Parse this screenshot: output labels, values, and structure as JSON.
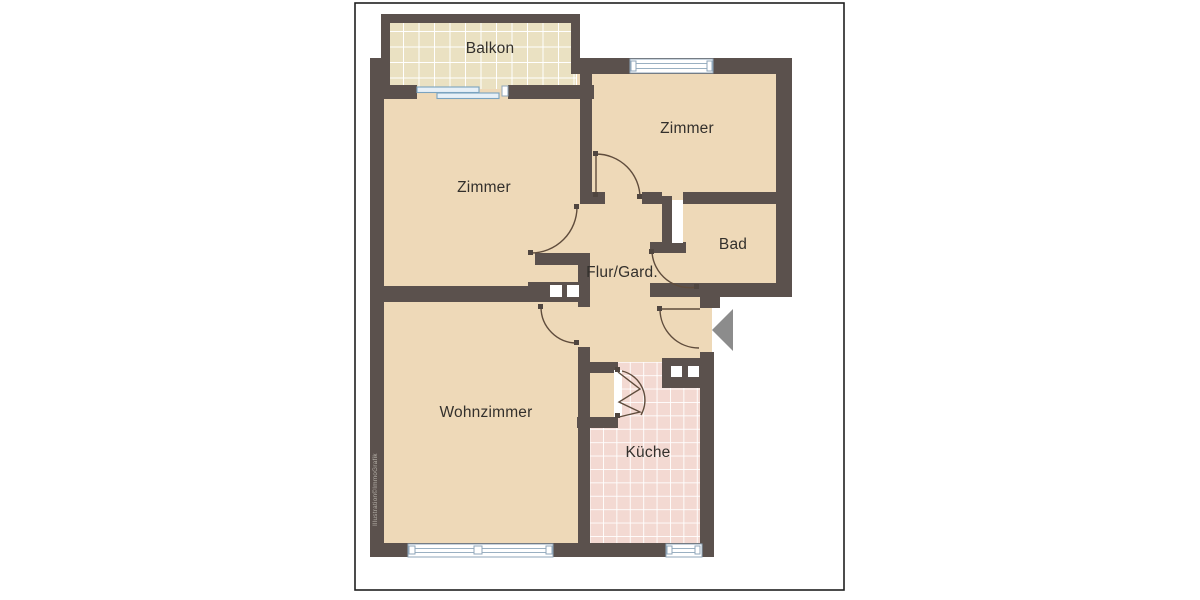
{
  "document": {
    "type": "floor-plan",
    "background": "#ffffff",
    "border_color": "#1f1f1f"
  },
  "colors": {
    "wall": "#5b514d",
    "floor": "#eed9b8",
    "balcony_tile": "#eae1c2",
    "kitchen_tile": "#f3d9d2",
    "tile_grid": "#ffffff",
    "window_frame": "#8fa6ba",
    "door_arc": "#5f4c3c",
    "entry_arrow": "#8c8c8c",
    "label_text": "#33302c"
  },
  "rooms": [
    {
      "id": "balkon",
      "label": "Balkon"
    },
    {
      "id": "zimmer-left",
      "label": "Zimmer"
    },
    {
      "id": "zimmer-right",
      "label": "Zimmer"
    },
    {
      "id": "bad",
      "label": "Bad"
    },
    {
      "id": "flur-garderobe",
      "label": "Flur/Gard."
    },
    {
      "id": "wohnzimmer",
      "label": "Wohnzimmer"
    },
    {
      "id": "kueche",
      "label": "Küche"
    }
  ],
  "watermark": {
    "text": "Illustration©ImmoGrafik"
  },
  "features": {
    "entry_arrow": "left-pointing-triangle",
    "windows": [
      "zimmer-right-top",
      "wohnzimmer-bottom",
      "kueche-bottom"
    ],
    "balcony_door": "sliding-door"
  }
}
